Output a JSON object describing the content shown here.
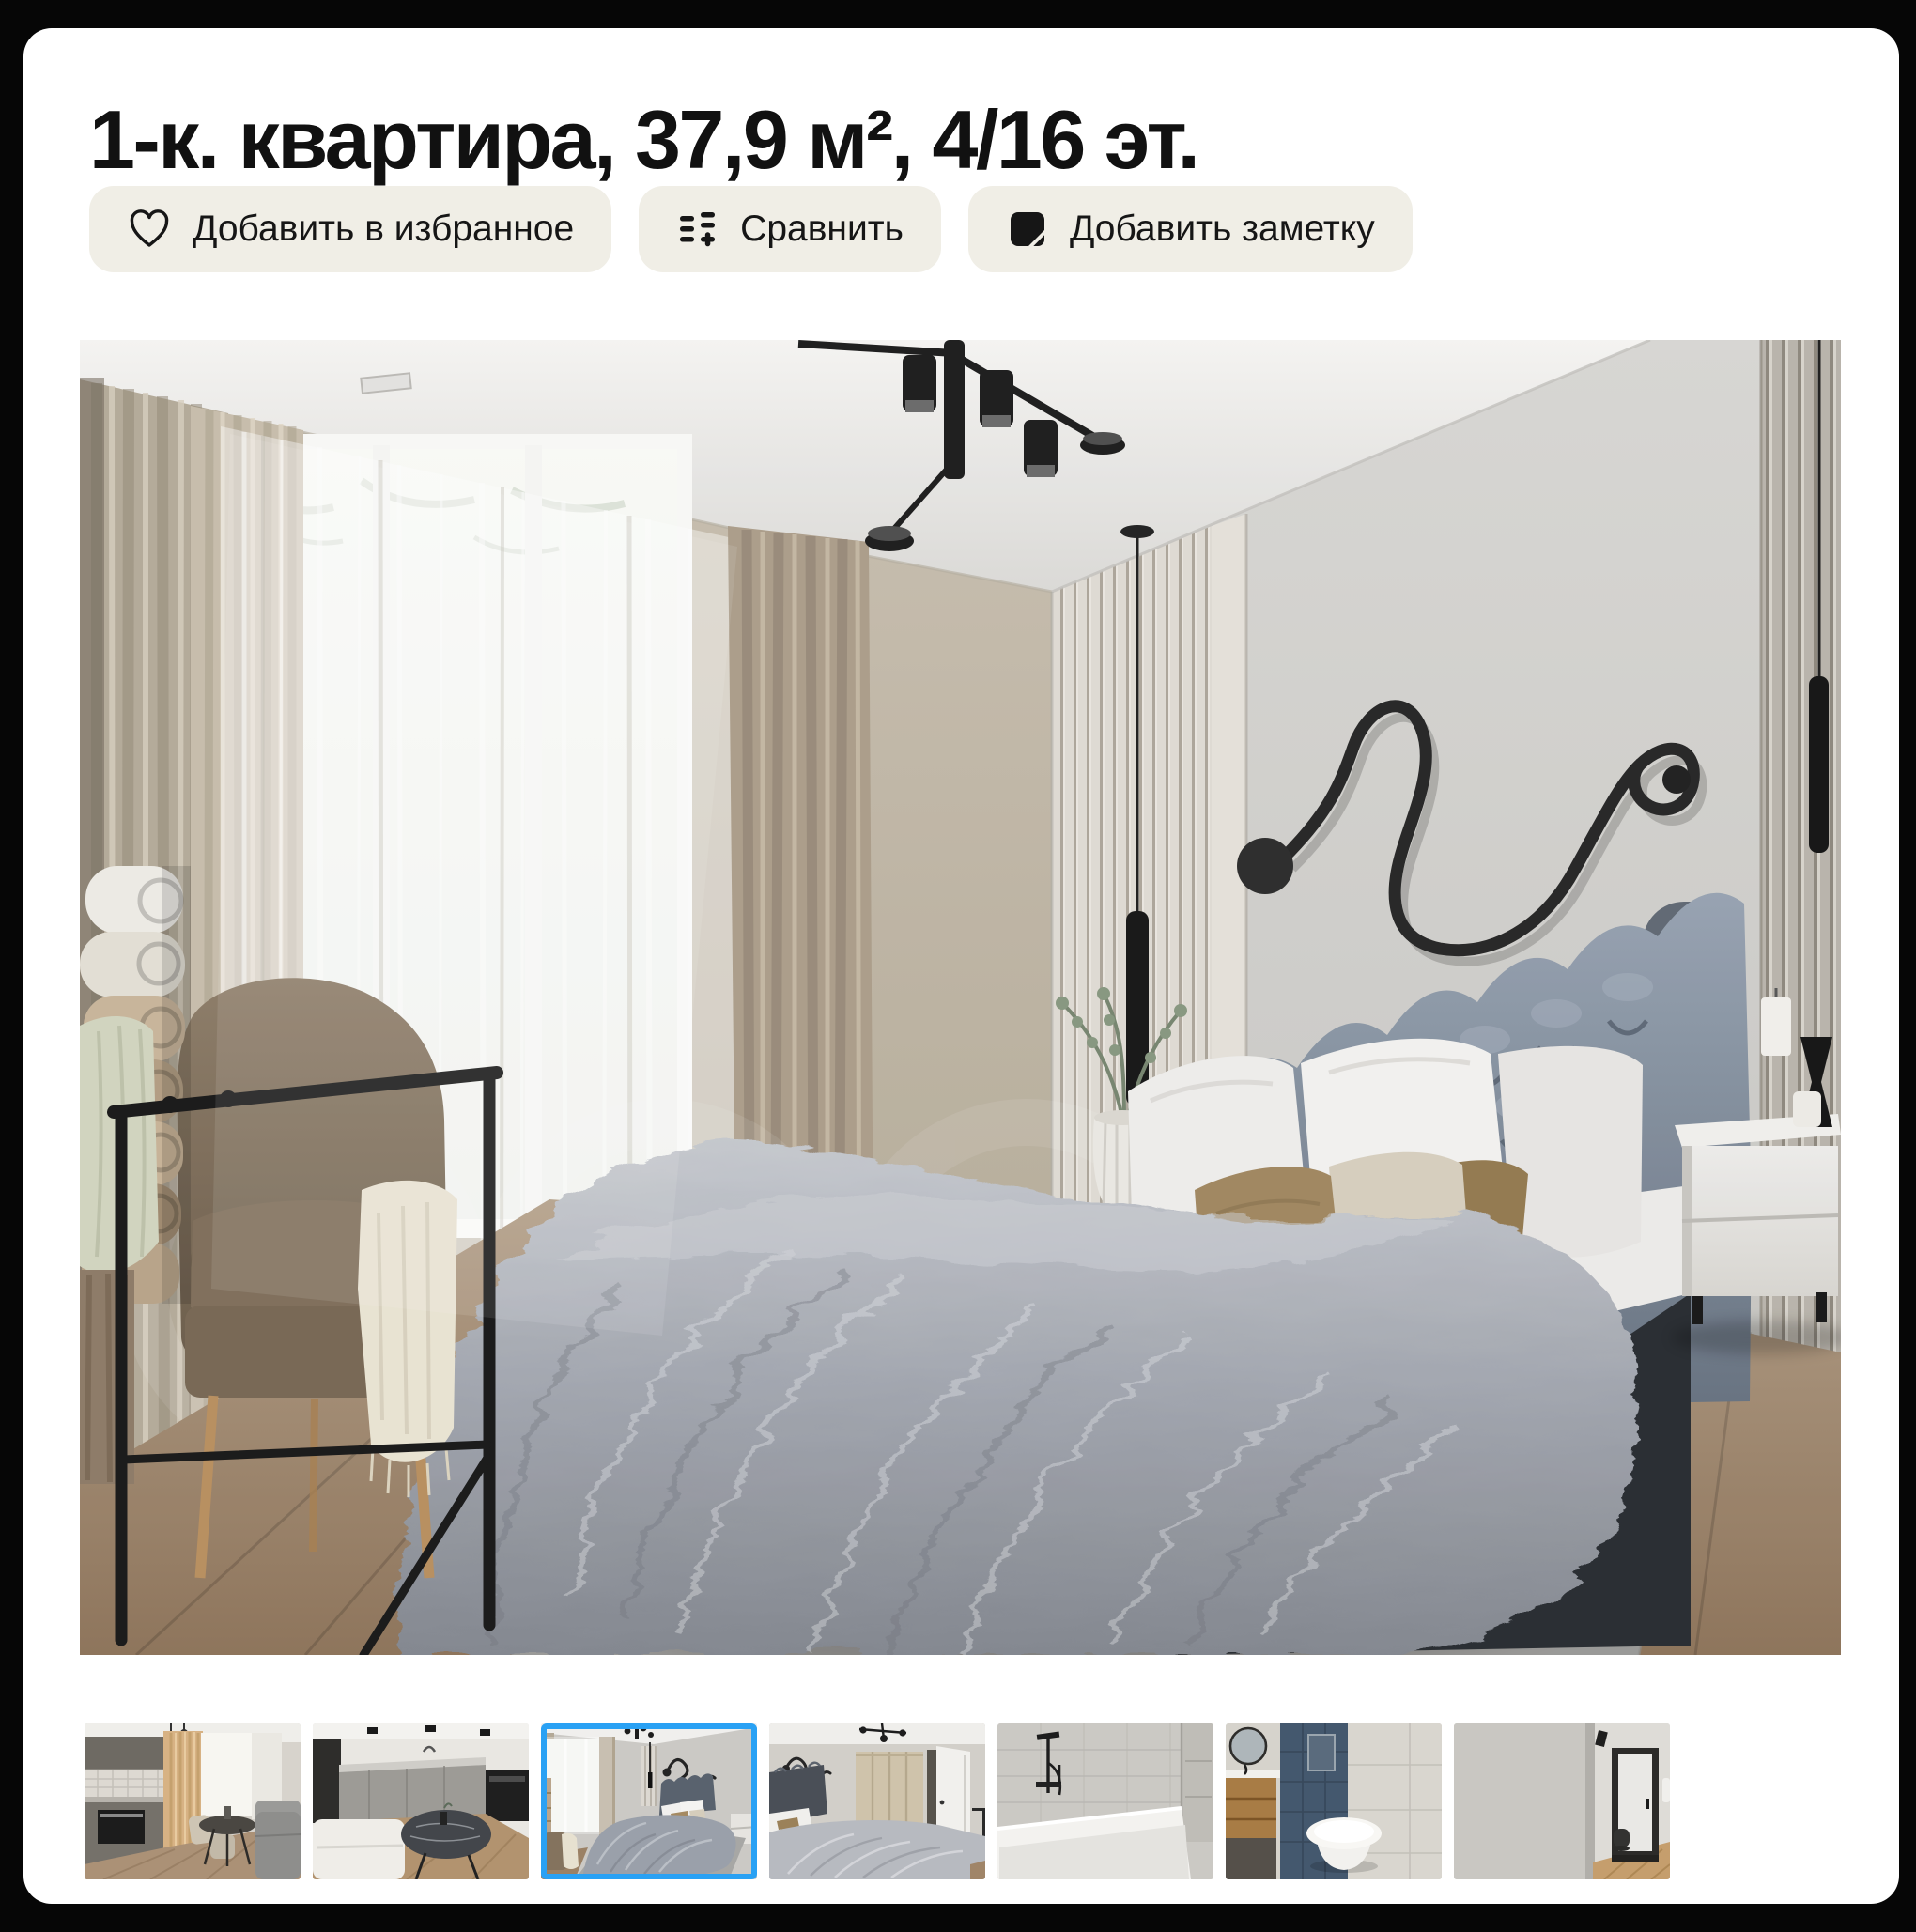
{
  "listing": {
    "title": "1-к. квартира, 37,9 м², 4/16 эт."
  },
  "actions": {
    "favorite": {
      "label": "Добавить в избранное",
      "icon": "heart-icon"
    },
    "compare": {
      "label": "Сравнить",
      "icon": "compare-icon"
    },
    "note": {
      "label": "Добавить заметку",
      "icon": "note-icon"
    }
  },
  "gallery": {
    "selected_index": 2,
    "main_photo": {
      "description": "Спальня: серая кровать с каретной стяжкой, окно с тюлем и бежевыми шторами, чёрный фигурный светильник на стене, тумбочка, кресло с пледом"
    },
    "thumbnails": [
      {
        "id": "kitchen-dining",
        "description": "Кухня со столовой зоной у окна"
      },
      {
        "id": "kitchen",
        "description": "Кухня с круглым столом"
      },
      {
        "id": "bedroom-main",
        "description": "Спальня с серой кроватью (выбрано)"
      },
      {
        "id": "bedroom-wardrobe",
        "description": "Спальня, вид на шкаф и дверь"
      },
      {
        "id": "bathroom-tub",
        "description": "Ванная комната с ванной и душем"
      },
      {
        "id": "bathroom-wc",
        "description": "Санузел с подвесным унитазом и синей плиткой"
      },
      {
        "id": "hallway",
        "description": "Прихожая со входной дверью"
      }
    ]
  },
  "theme": {
    "frame_bg": "#060606",
    "card_bg": "#ffffff",
    "chip_bg": "#f0eee6",
    "text": "#161616",
    "accent_blue": "#29a1f4"
  }
}
